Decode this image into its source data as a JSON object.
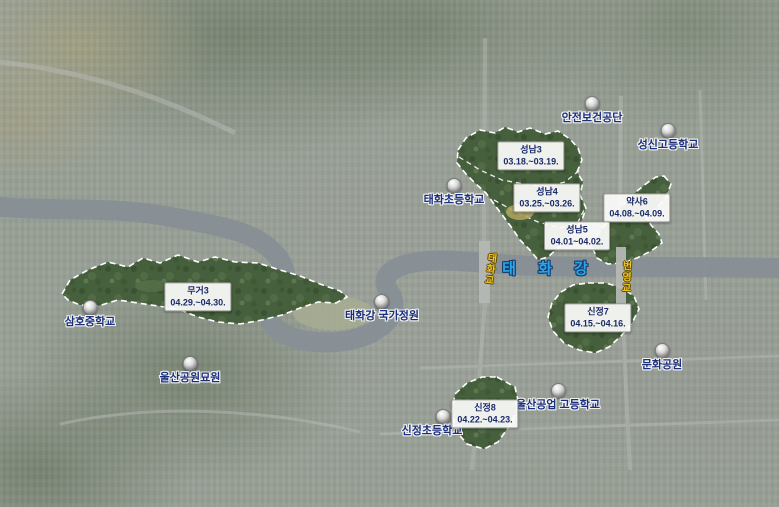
{
  "river": {
    "label": "태 화 강"
  },
  "bridges": [
    {
      "label": "태화교"
    },
    {
      "label": "번영교"
    }
  ],
  "pois": [
    {
      "label": "안전보건공단"
    },
    {
      "label": "성신고등학교"
    },
    {
      "label": "태화초등학교"
    },
    {
      "label": "삼호중학교"
    },
    {
      "label": "태화강 국가정원"
    },
    {
      "label": "울산공원묘원"
    },
    {
      "label": "문화공원"
    },
    {
      "label": "울산공업 고등학교"
    },
    {
      "label": "신정초등학교"
    }
  ],
  "areas": [
    {
      "name": "성남3",
      "dates": "03.18.~03.19."
    },
    {
      "name": "성남4",
      "dates": "03.25.~03.26."
    },
    {
      "name": "약사6",
      "dates": "04.08.~04.09."
    },
    {
      "name": "성남5",
      "dates": "04.01~04.02."
    },
    {
      "name": "무거3",
      "dates": "04.29.~04.30."
    },
    {
      "name": "신정7",
      "dates": "04.15.~04.16."
    },
    {
      "name": "신정8",
      "dates": "04.22.~04.23."
    }
  ],
  "colors": {
    "poi_text": "#1b2f80",
    "area_text": "#1c2a6b",
    "river_text": "#28a7e8",
    "bridge_text": "#f2c41e",
    "zone_fill": "#465f3d",
    "zone_outline": "#ffffff"
  }
}
